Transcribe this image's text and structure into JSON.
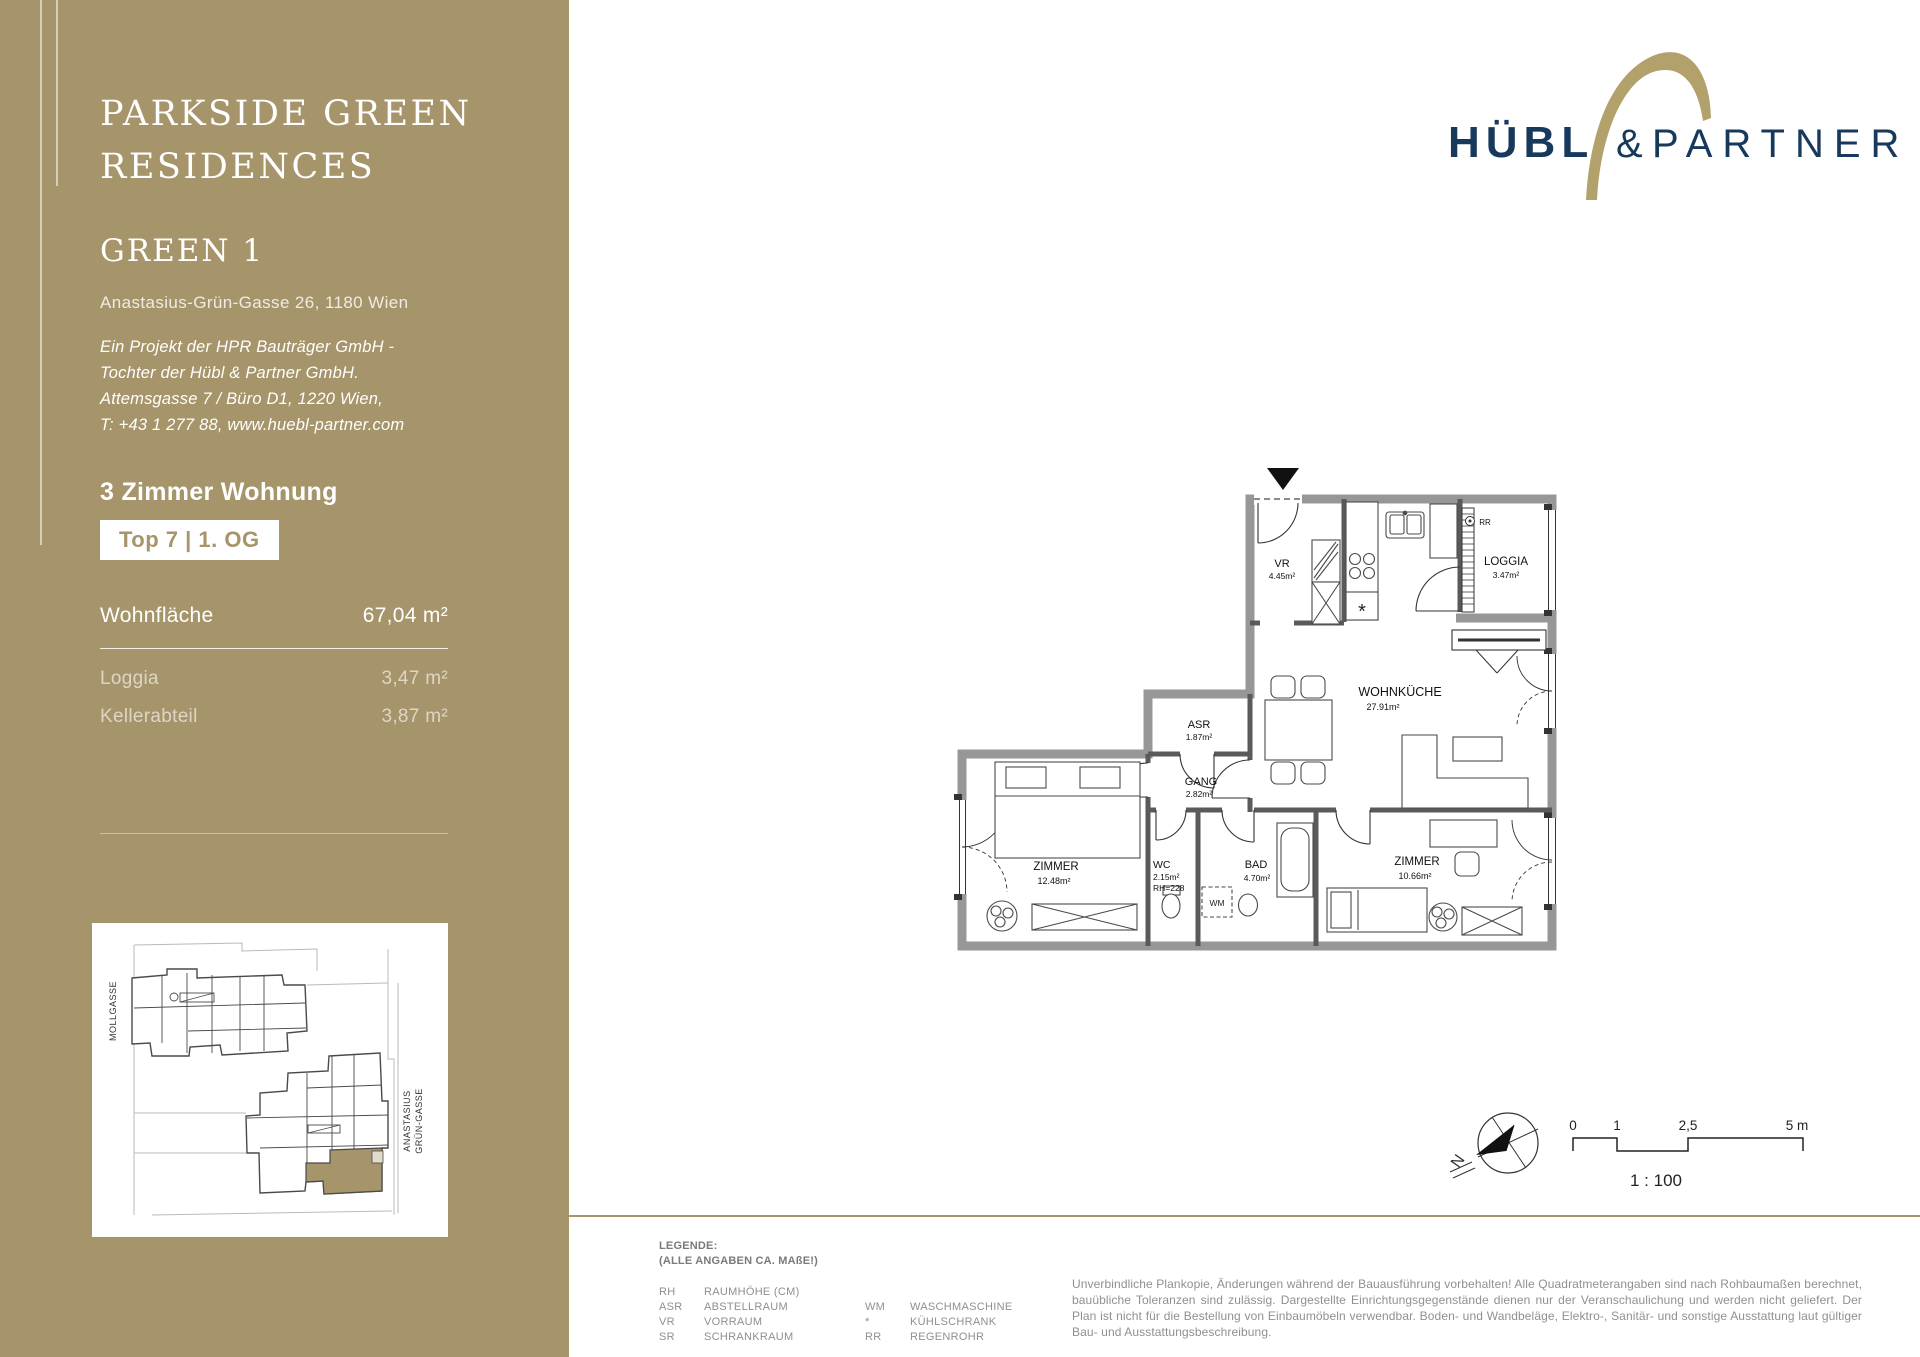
{
  "sidebar": {
    "title_line1": "PARKSIDE GREEN",
    "title_line2": "RESIDENCES",
    "project_name": "GREEN 1",
    "address": "Anastasius-Grün-Gasse 26, 1180 Wien",
    "company_lines": [
      "Ein Projekt der HPR Bauträger GmbH -",
      "Tochter der Hübl & Partner GmbH.",
      "Attemsgasse 7 / Büro D1, 1220 Wien,",
      "T: +43 1 277 88, www.huebl-partner.com"
    ],
    "apartment_type": "3 Zimmer Wohnung",
    "unit_badge": "Top 7 | 1. OG",
    "area_table": {
      "main_label": "Wohnfläche",
      "main_value": "67,04 m²",
      "rows": [
        {
          "label": "Loggia",
          "value": "3,47 m²"
        },
        {
          "label": "Kellerabteil",
          "value": "3,87 m²"
        }
      ]
    },
    "site_map": {
      "street_left": "MOLLGASSE",
      "street_right_line1": "ANASTASIUS",
      "street_right_line2": "GRÜN-GASSE"
    }
  },
  "logo": {
    "word1": "HÜBL",
    "ampersand": "&",
    "word2": "PARTNER"
  },
  "floor_plan": {
    "rooms": {
      "vr": {
        "name": "VR",
        "area": "4.45m²"
      },
      "loggia": {
        "name": "LOGGIA",
        "area": "3.47m²"
      },
      "wohnkueche": {
        "name": "WOHNKÜCHE",
        "area": "27.91m²"
      },
      "asr": {
        "name": "ASR",
        "area": "1.87m²"
      },
      "gang": {
        "name": "GANG",
        "area": "2.82m²"
      },
      "zimmer_west": {
        "name": "ZIMMER",
        "area": "12.48m²"
      },
      "wc": {
        "name": "WC",
        "area": "2.15m²",
        "room_height": "RH=228"
      },
      "bad": {
        "name": "BAD",
        "area": "4.70m²"
      },
      "zimmer_ost": {
        "name": "ZIMMER",
        "area": "10.66m²"
      }
    },
    "symbols": {
      "rainpipe": "RR",
      "washing_machine": "WM",
      "fridge": "*"
    }
  },
  "scale_area": {
    "north_letter": "N",
    "ticks": [
      "0",
      "1",
      "2,5",
      "5 m"
    ],
    "ratio": "1 : 100"
  },
  "legend": {
    "title": "LEGENDE:",
    "note": "(ALLE ANGABEN CA. MAßE!)",
    "rows": [
      {
        "a": "RH",
        "d": "RAUMHÖHE (CM)",
        "a2": "",
        "d2": ""
      },
      {
        "a": "ASR",
        "d": "ABSTELLRAUM",
        "a2": "WM",
        "d2": "WASCHMASCHINE"
      },
      {
        "a": "VR",
        "d": "VORRAUM",
        "a2": "*",
        "d2": "KÜHLSCHRANK"
      },
      {
        "a": "SR",
        "d": "SCHRANKRAUM",
        "a2": "RR",
        "d2": "REGENROHR"
      }
    ]
  },
  "disclaimer": "Unverbindliche Plankopie, Änderungen während der Bauausführung vorbehalten! Alle Quadratmeterangaben sind nach Rohbaumaßen berechnet, bauübliche Toleranzen sind zulässig.  Dargestellte Einrichtungsgegenstände dienen nur der Veranschaulichung und werden nicht geliefert. Der Plan ist nicht für die Bestellung von Einbaumöbeln verwendbar. Boden- und Wandbeläge, Elektro-, Sanitär- und sonstige Ausstattung laut gültiger Bau- und Ausstattungsbeschreibung.",
  "colors": {
    "brand_tan": "#a6946a",
    "brand_navy": "#17395c",
    "logo_gold": "#b2a16b"
  }
}
